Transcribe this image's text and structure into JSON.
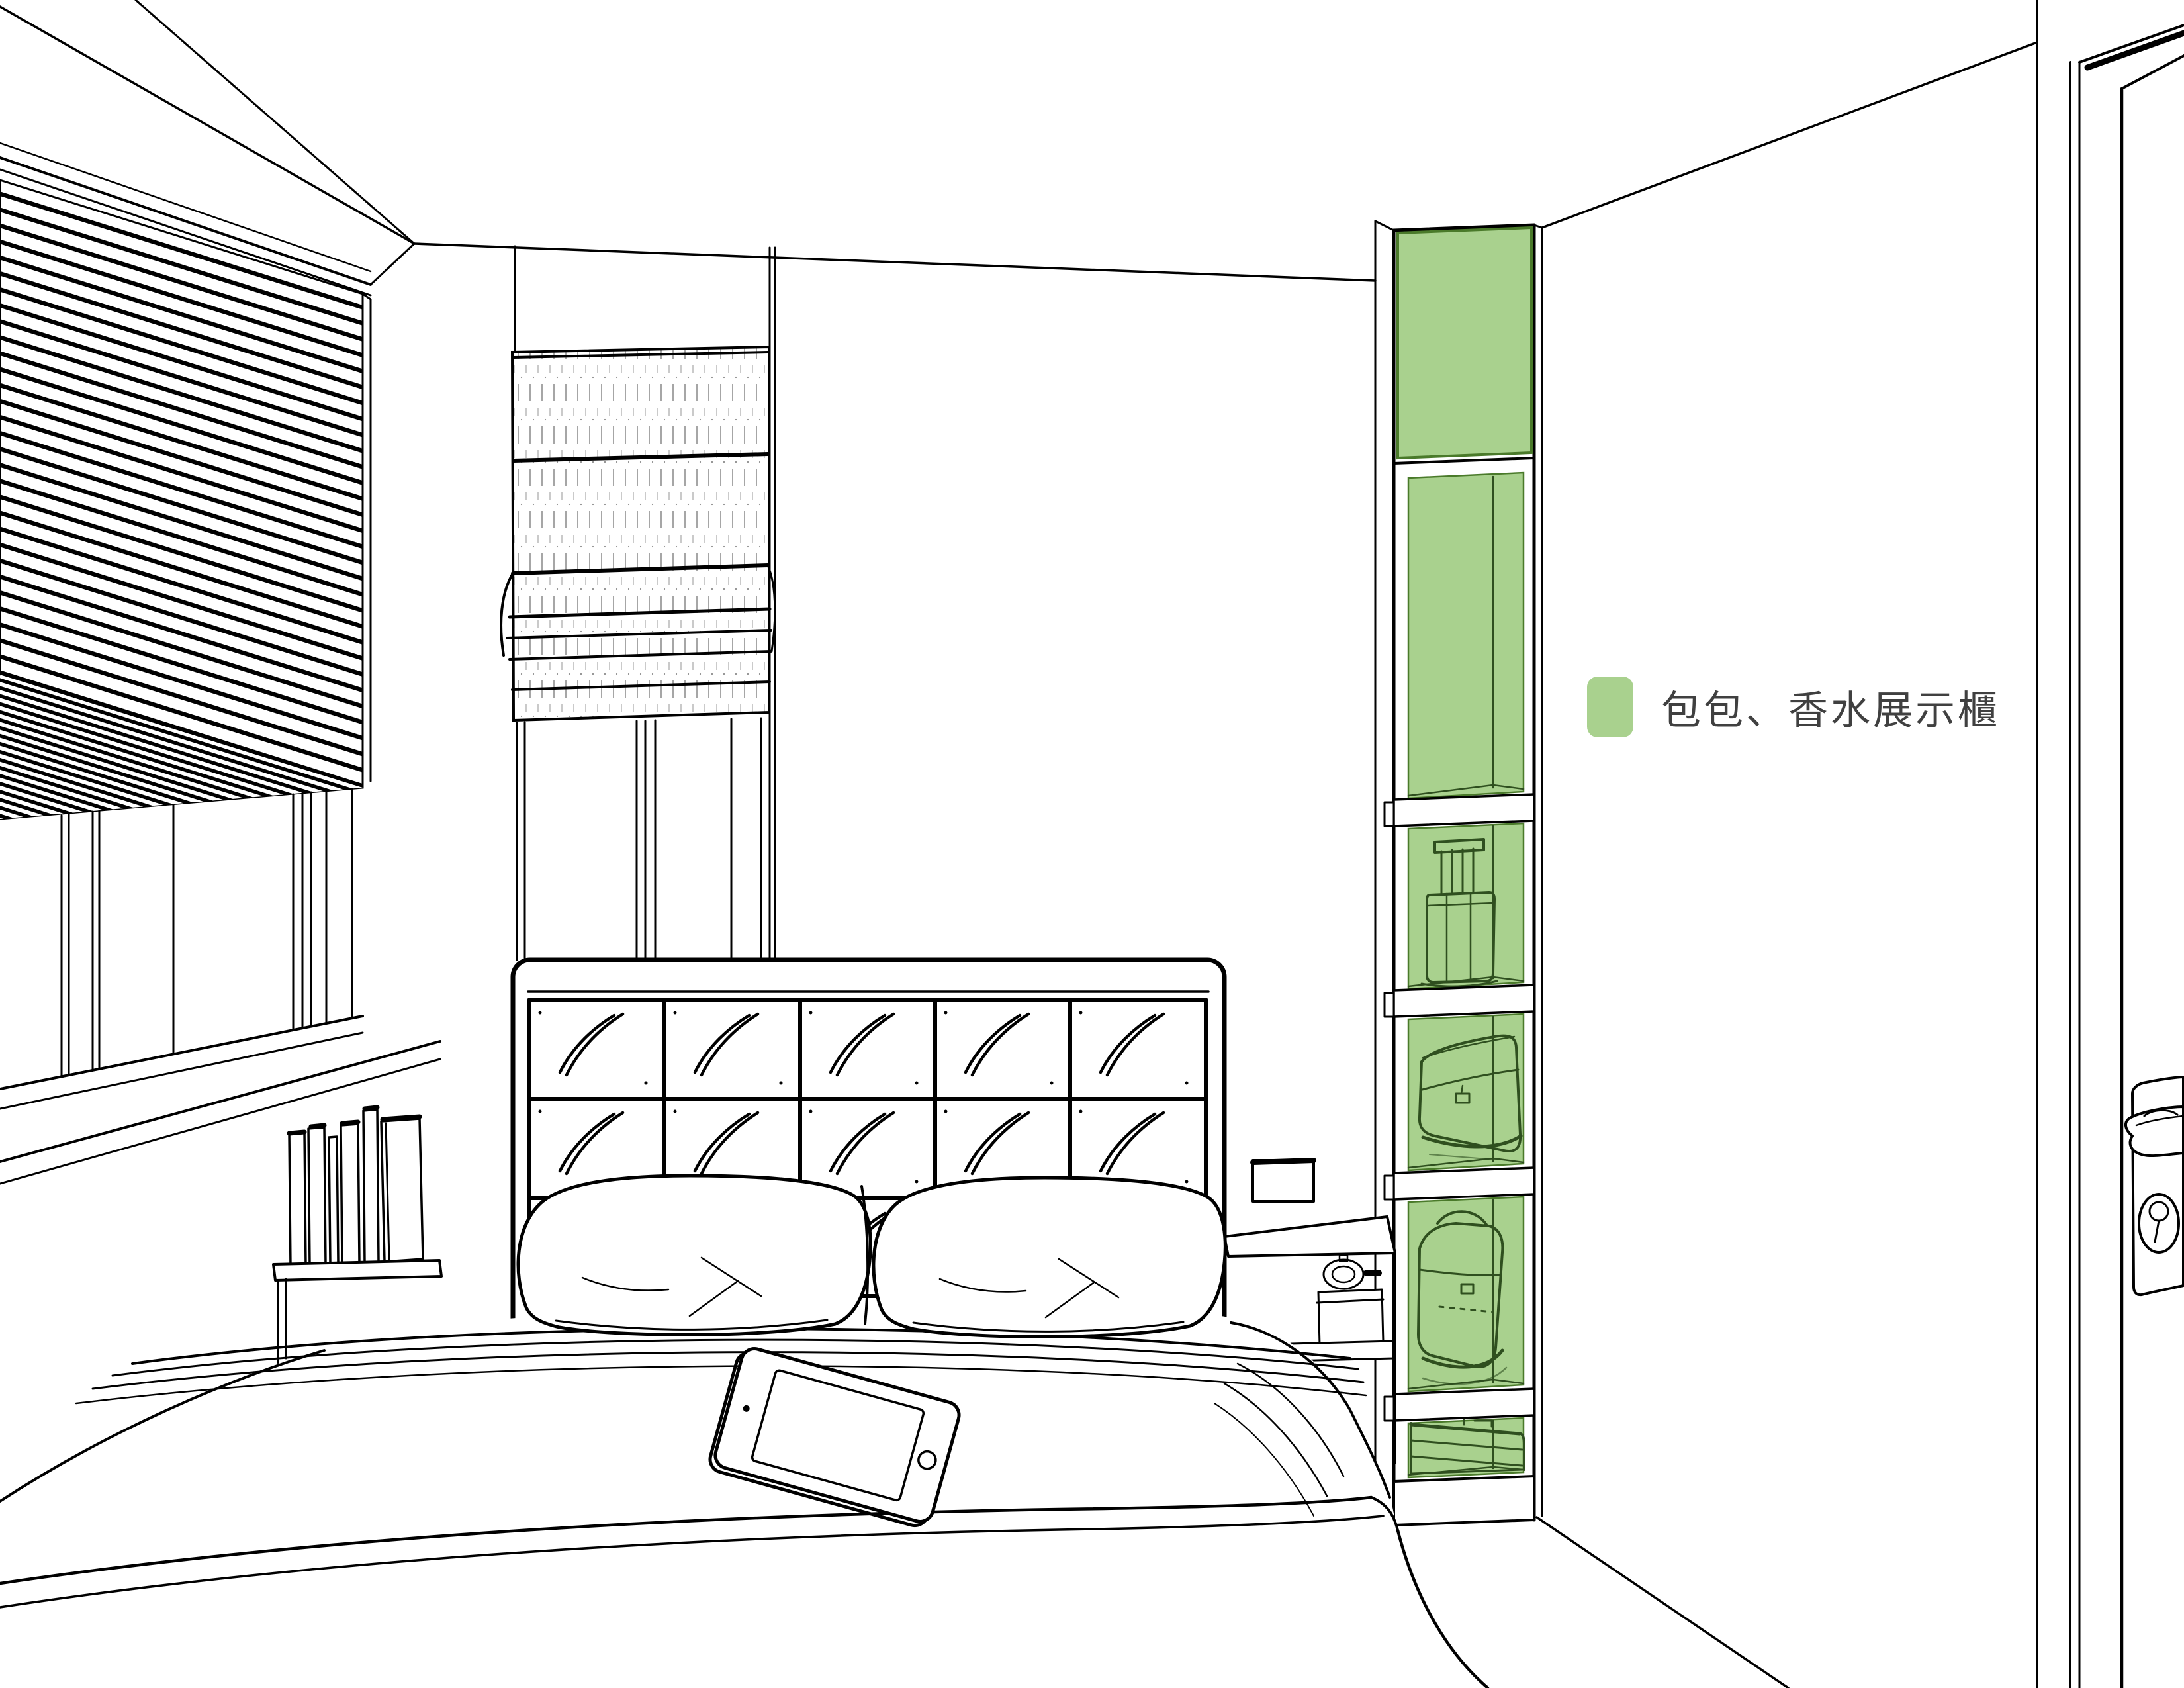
{
  "scene": {
    "description": "Black-and-white architectural line rendering of a bedroom; a tall display cabinet is highlighted in green",
    "room": "bedroom",
    "highlight_color": "#A9D18E",
    "highlight_outline_color": "#4a7a2a",
    "line_color": "#000000",
    "objects": [
      "pleated-blind-window",
      "roman-shade-window",
      "tufted-headboard",
      "bed",
      "pillows",
      "tablet",
      "books-on-shelf",
      "wall-switch-panel",
      "nightstand",
      "clock-and-box",
      "display-cabinet",
      "cabinet-door",
      "perfume-bottle",
      "clutch-bag",
      "handbag",
      "suitcase",
      "door",
      "door-handle",
      "keyhole"
    ]
  },
  "legend": {
    "label": "包包、香水展示櫃",
    "swatch_color": "#A9D18E",
    "text_color": "#404040"
  }
}
